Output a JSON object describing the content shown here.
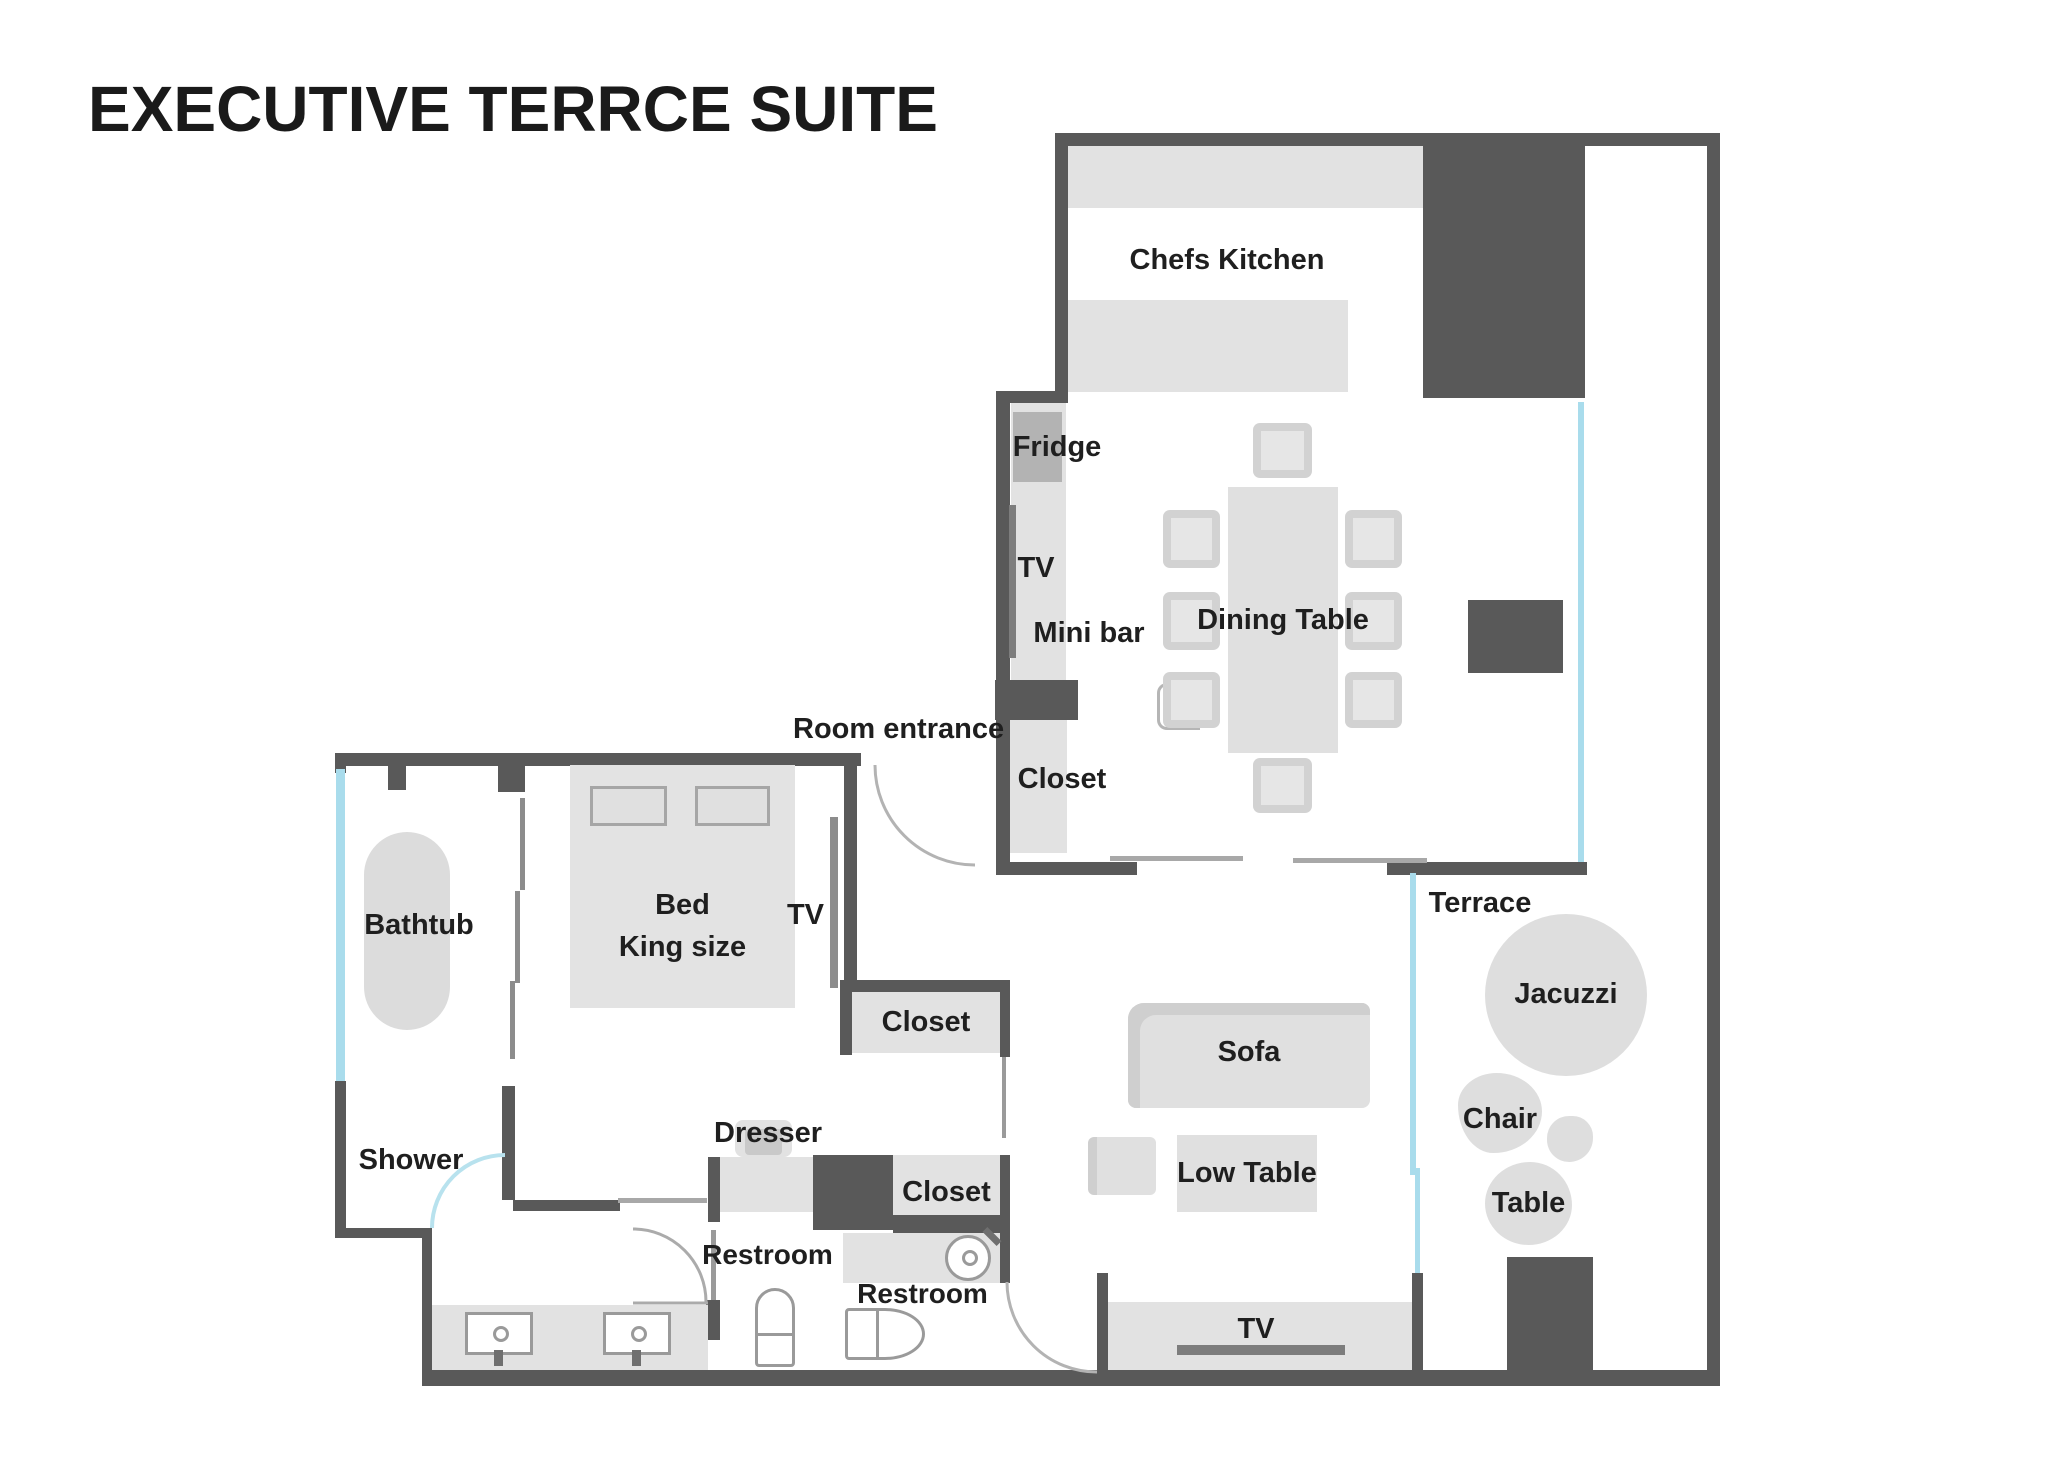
{
  "title": "EXECUTIVE TERRCE SUITE",
  "labels": {
    "kitchen": "Chefs Kitchen",
    "fridge": "Fridge",
    "tv_dining": "TV",
    "mini_bar": "Mini bar",
    "dining_table": "Dining Table",
    "closet_entry": "Closet",
    "room_entrance": "Room entrance",
    "bathtub": "Bathtub",
    "bed_line1": "Bed",
    "bed_line2": "King size",
    "tv_bedroom": "TV",
    "closet_bedroom": "Closet",
    "shower": "Shower",
    "dresser": "Dresser",
    "closet_hall": "Closet",
    "restroom_inner": "Restroom",
    "restroom_outer": "Restroom",
    "sofa": "Sofa",
    "low_table": "Low Table",
    "tv_living": "TV",
    "terrace": "Terrace",
    "jacuzzi": "Jacuzzi",
    "chair": "Chair",
    "table": "Table"
  },
  "colors": {
    "wall": "#595959",
    "furniture": "#e2e2e2",
    "appliance": "#b3b3b3",
    "glass": "#a9dcec",
    "tv_bar": "#8c8c8c",
    "door_arc": "#b3b3b3",
    "text": "#1f1f1f",
    "background": "#ffffff"
  }
}
